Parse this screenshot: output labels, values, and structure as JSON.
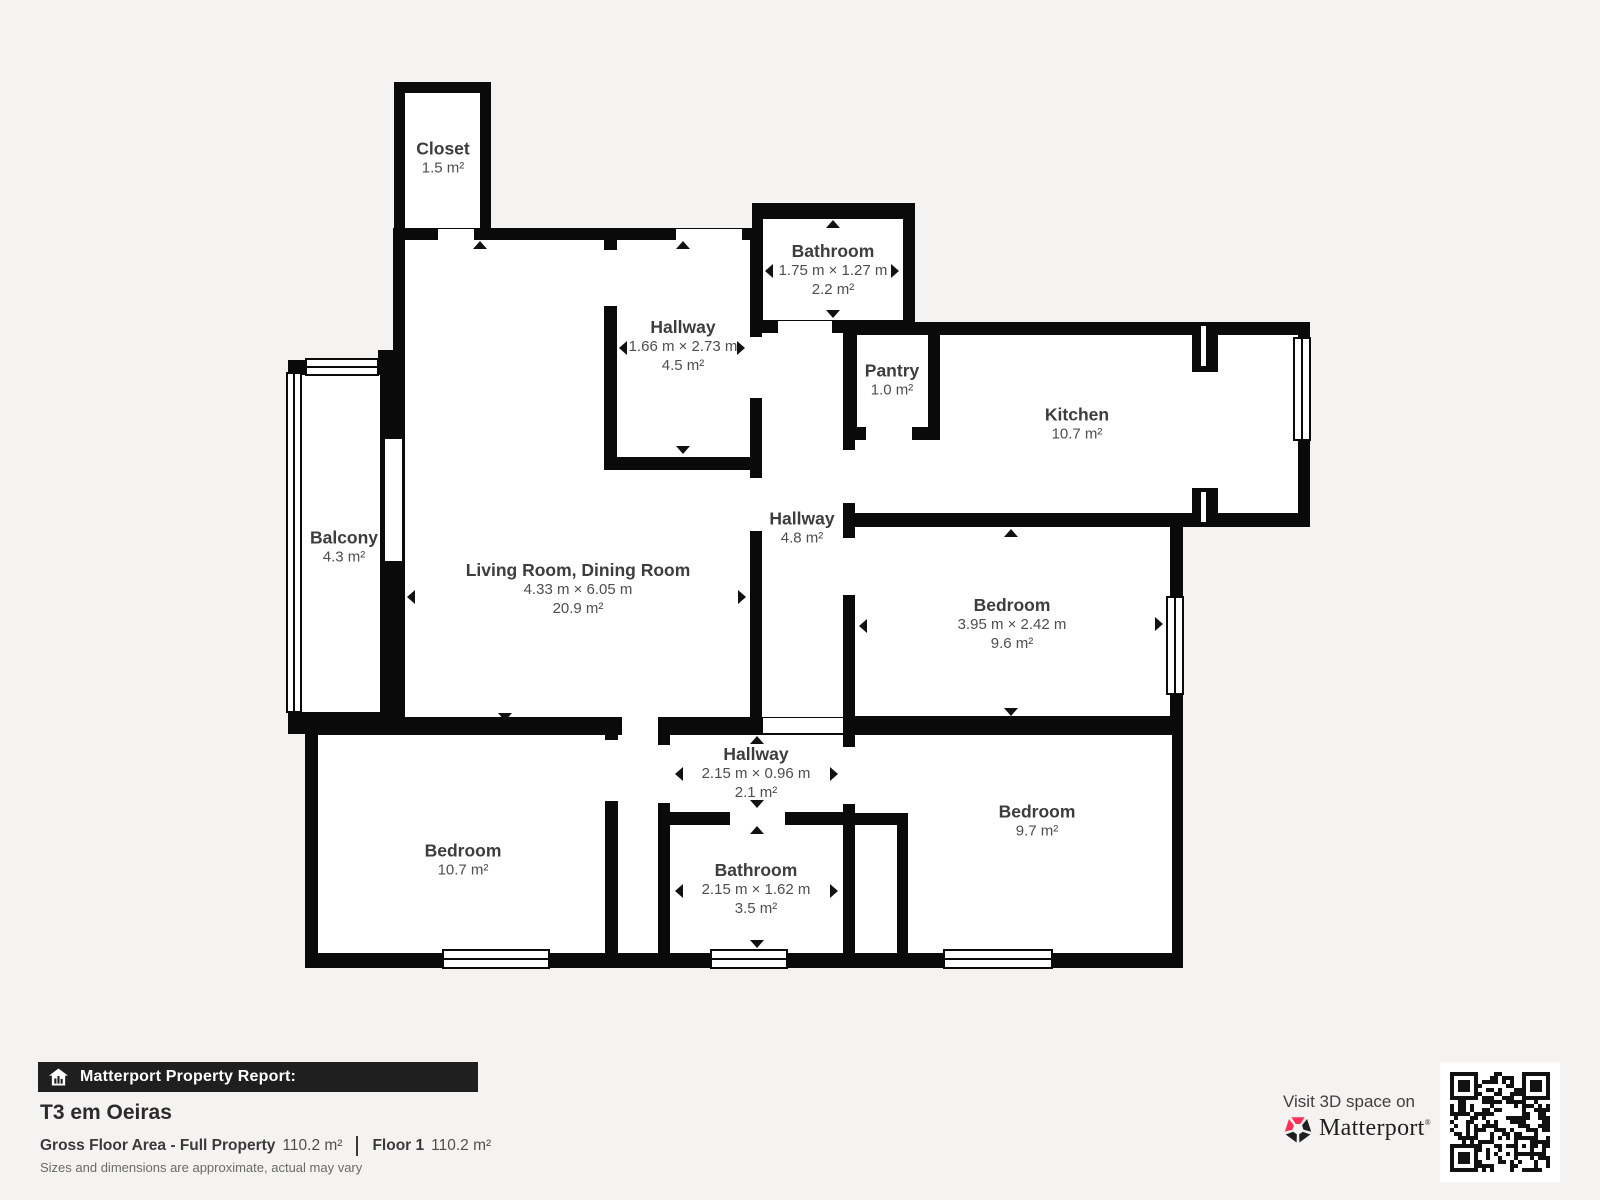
{
  "background": "#f4f3f1",
  "colors": {
    "wall": "#0a0a0a",
    "room_fill": "#ffffff",
    "label_text": "#3d3d3d",
    "sublabel_text": "#4e4e4e",
    "banner_background": "#1f1f1f",
    "matterport_pink": "#ff3158"
  },
  "plan": {
    "rooms": [
      {
        "id": "closet",
        "name": "Closet",
        "area": "1.5 m²"
      },
      {
        "id": "bathroom-top",
        "name": "Bathroom",
        "dimensions": "1.75 m × 1.27 m",
        "area": "2.2 m²"
      },
      {
        "id": "hallway-top",
        "name": "Hallway",
        "dimensions": "1.66 m × 2.73 m",
        "area": "4.5 m²"
      },
      {
        "id": "pantry",
        "name": "Pantry",
        "area": "1.0 m²"
      },
      {
        "id": "kitchen",
        "name": "Kitchen",
        "area": "10.7 m²"
      },
      {
        "id": "hallway-central",
        "name": "Hallway",
        "area": "4.8 m²"
      },
      {
        "id": "living-room",
        "name": "Living Room, Dining Room",
        "dimensions": "4.33 m × 6.05 m",
        "area": "20.9 m²"
      },
      {
        "id": "balcony",
        "name": "Balcony",
        "area": "4.3 m²"
      },
      {
        "id": "bedroom-right",
        "name": "Bedroom",
        "dimensions": "3.95 m × 2.42 m",
        "area": "9.6 m²"
      },
      {
        "id": "hallway-bottom",
        "name": "Hallway",
        "dimensions": "2.15 m × 0.96 m",
        "area": "2.1 m²"
      },
      {
        "id": "bathroom-bottom",
        "name": "Bathroom",
        "dimensions": "2.15 m × 1.62 m",
        "area": "3.5 m²"
      },
      {
        "id": "bedroom-left",
        "name": "Bedroom",
        "area": "10.7 m²"
      },
      {
        "id": "bedroom-bottom-right",
        "name": "Bedroom",
        "area": "9.7 m²"
      }
    ]
  },
  "footer": {
    "report_label": "Matterport Property Report:",
    "property_title": "T3 em Oeiras",
    "gross_floor_area_label": "Gross Floor Area - Full Property",
    "gross_floor_area_value": "110.2 m²",
    "floor_label": "Floor 1",
    "floor_value": "110.2 m²",
    "disclaimer": "Sizes and dimensions are approximate, actual may vary"
  },
  "visit": {
    "text": "Visit 3D space on",
    "brand": "Matterport",
    "brand_mark": "®"
  }
}
